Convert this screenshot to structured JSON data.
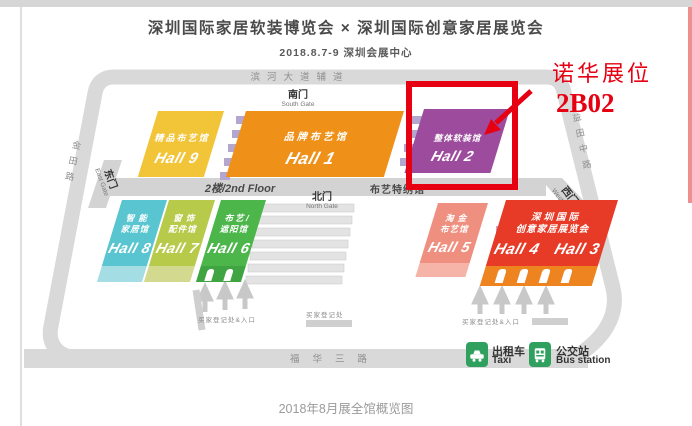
{
  "header": {
    "title": "深圳国际家居软装博览会 × 深圳国际创意家居展览会",
    "subtitle": "2018.8.7-9  深圳会展中心"
  },
  "annotation": {
    "booth_name": "诺华展位",
    "booth_number": "2B02"
  },
  "roads": {
    "top": "滨河大道辅道",
    "bottom": "福华三路",
    "left": "金田路",
    "right": "益田中路"
  },
  "gates": {
    "south": {
      "cn": "南门",
      "en": "South Gate"
    },
    "north": {
      "cn": "北门",
      "en": "North Gate"
    },
    "east": {
      "cn": "东门",
      "en": "East Gate"
    },
    "west": {
      "cn": "西门",
      "en": "West Gate"
    }
  },
  "floor2": {
    "label": "2楼/2nd Floor",
    "special_hall": "布艺特绣馆"
  },
  "halls": {
    "h9": {
      "name": "精品布艺馆",
      "label": "Hall 9"
    },
    "h1": {
      "name": "品牌布艺馆",
      "label": "Hall 1"
    },
    "h2": {
      "name": "整体软装馆",
      "label": "Hall 2"
    },
    "h8": {
      "line1": "智能",
      "line2": "家居馆",
      "label": "Hall 8"
    },
    "h7": {
      "line1": "窗饰",
      "line2": "配件馆",
      "label": "Hall 7"
    },
    "h6": {
      "line1": "布艺/",
      "line2": "遮阳馆",
      "label": "Hall 6"
    },
    "h5": {
      "line1": "淘金",
      "line2": "布艺馆",
      "label": "Hall 5"
    },
    "h43": {
      "line1": "深圳国际",
      "line2": "创意家居展览会",
      "label4": "Hall 4",
      "label3": "Hall 3"
    }
  },
  "signs": {
    "reg_entrance_left": "买家登记处&入口",
    "reg_center": "买家登记处",
    "reg_entrance_right": "买家登记处&入口"
  },
  "transport": {
    "taxi": {
      "cn": "出租车",
      "en": "Taxi"
    },
    "bus": {
      "cn": "公交站",
      "en": "Bus station"
    }
  },
  "caption": "2018年8月展全馆概览图",
  "colors": {
    "accent_red": "#e60012",
    "hall9": "#f2c438",
    "hall1": "#ef9019",
    "hall2": "#9d4b9d",
    "hall8": "#58c5d0",
    "hall8_side": "#a5dde4",
    "hall7": "#b7ca49",
    "hall7_side": "#d3d98e",
    "hall6": "#4cb64a",
    "hall6_side": "#3fa441",
    "hall5": "#ef8f80",
    "hall5_side": "#f6b4a8",
    "hall43": "#e73b27",
    "hall43_side": "#ee8420",
    "road_gray": "#d9d9d9",
    "transport_green": "#2fa05e"
  }
}
